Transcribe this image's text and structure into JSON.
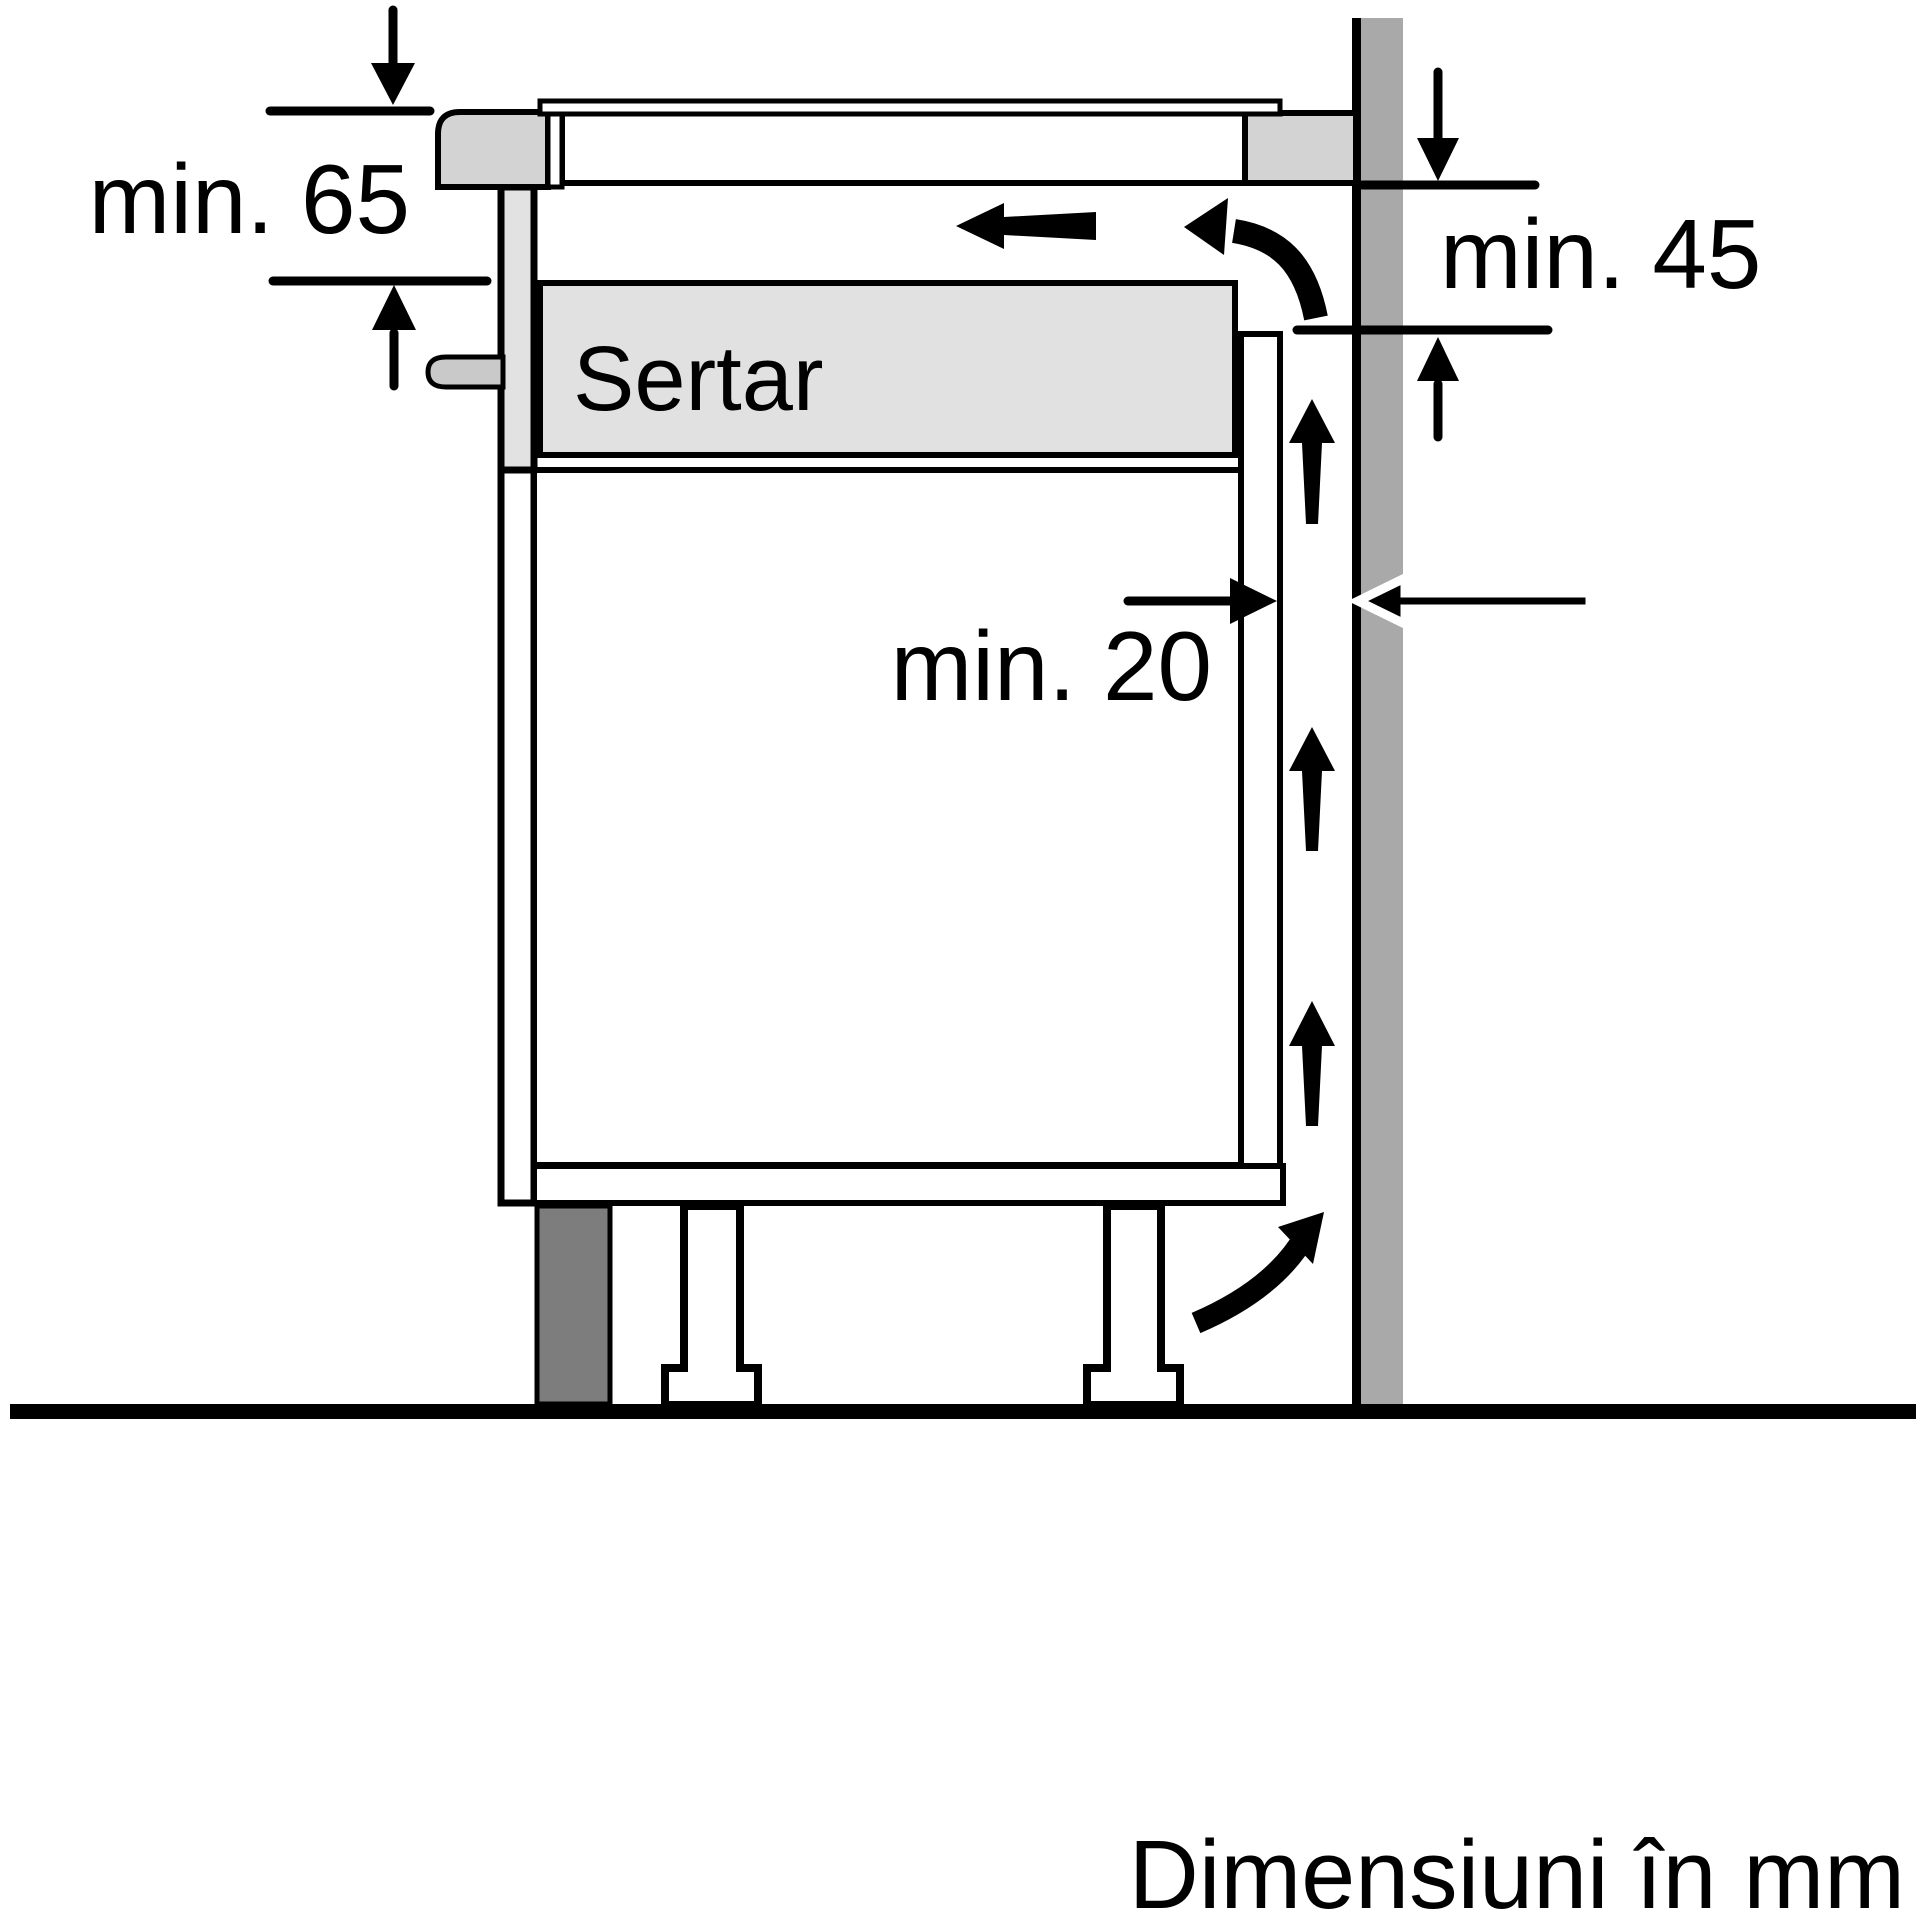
{
  "labels": {
    "dim_countertop_thickness": "min. 65",
    "dim_wall_clearance_height": "min. 45",
    "dim_rear_gap": "min. 20",
    "drawer": "Sertar",
    "units_note": "Dimensiuni în mm"
  },
  "colors": {
    "outline": "#000000",
    "appliance_gray": "#d3d3d3",
    "drawer_gray": "#e1e1e1",
    "panel_gray": "#e2e2e2",
    "peg_gray": "#c9c9c9",
    "wall_gray": "#a9a9a9",
    "plinth_dark_gray": "#7d7d7d",
    "background": "#ffffff"
  },
  "icons": {
    "airflow_up_arrows": "up-arrow-icon",
    "airflow_exit_arrow": "left-arrow-icon",
    "airflow_curve_top": "curved-arrow-icon",
    "airflow_curve_bottom": "curved-arrow-icon",
    "dimension_arrows": "dimension-arrow-icon"
  }
}
